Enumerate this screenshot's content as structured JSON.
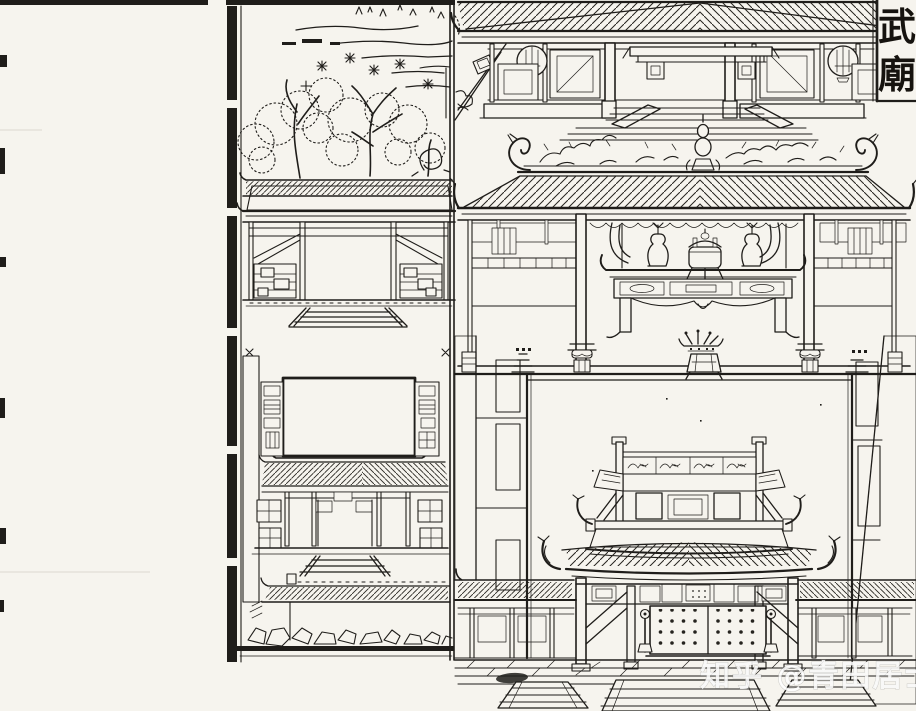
{
  "page": {
    "title_cartouche": {
      "text": "武廟",
      "chars": [
        "武",
        "廟"
      ]
    },
    "watermark": {
      "text": "知乎 @青田居士"
    },
    "colors": {
      "paper": "#f6f4ee",
      "ink": "#1f1d1a",
      "watermark": "#ffffff"
    }
  }
}
